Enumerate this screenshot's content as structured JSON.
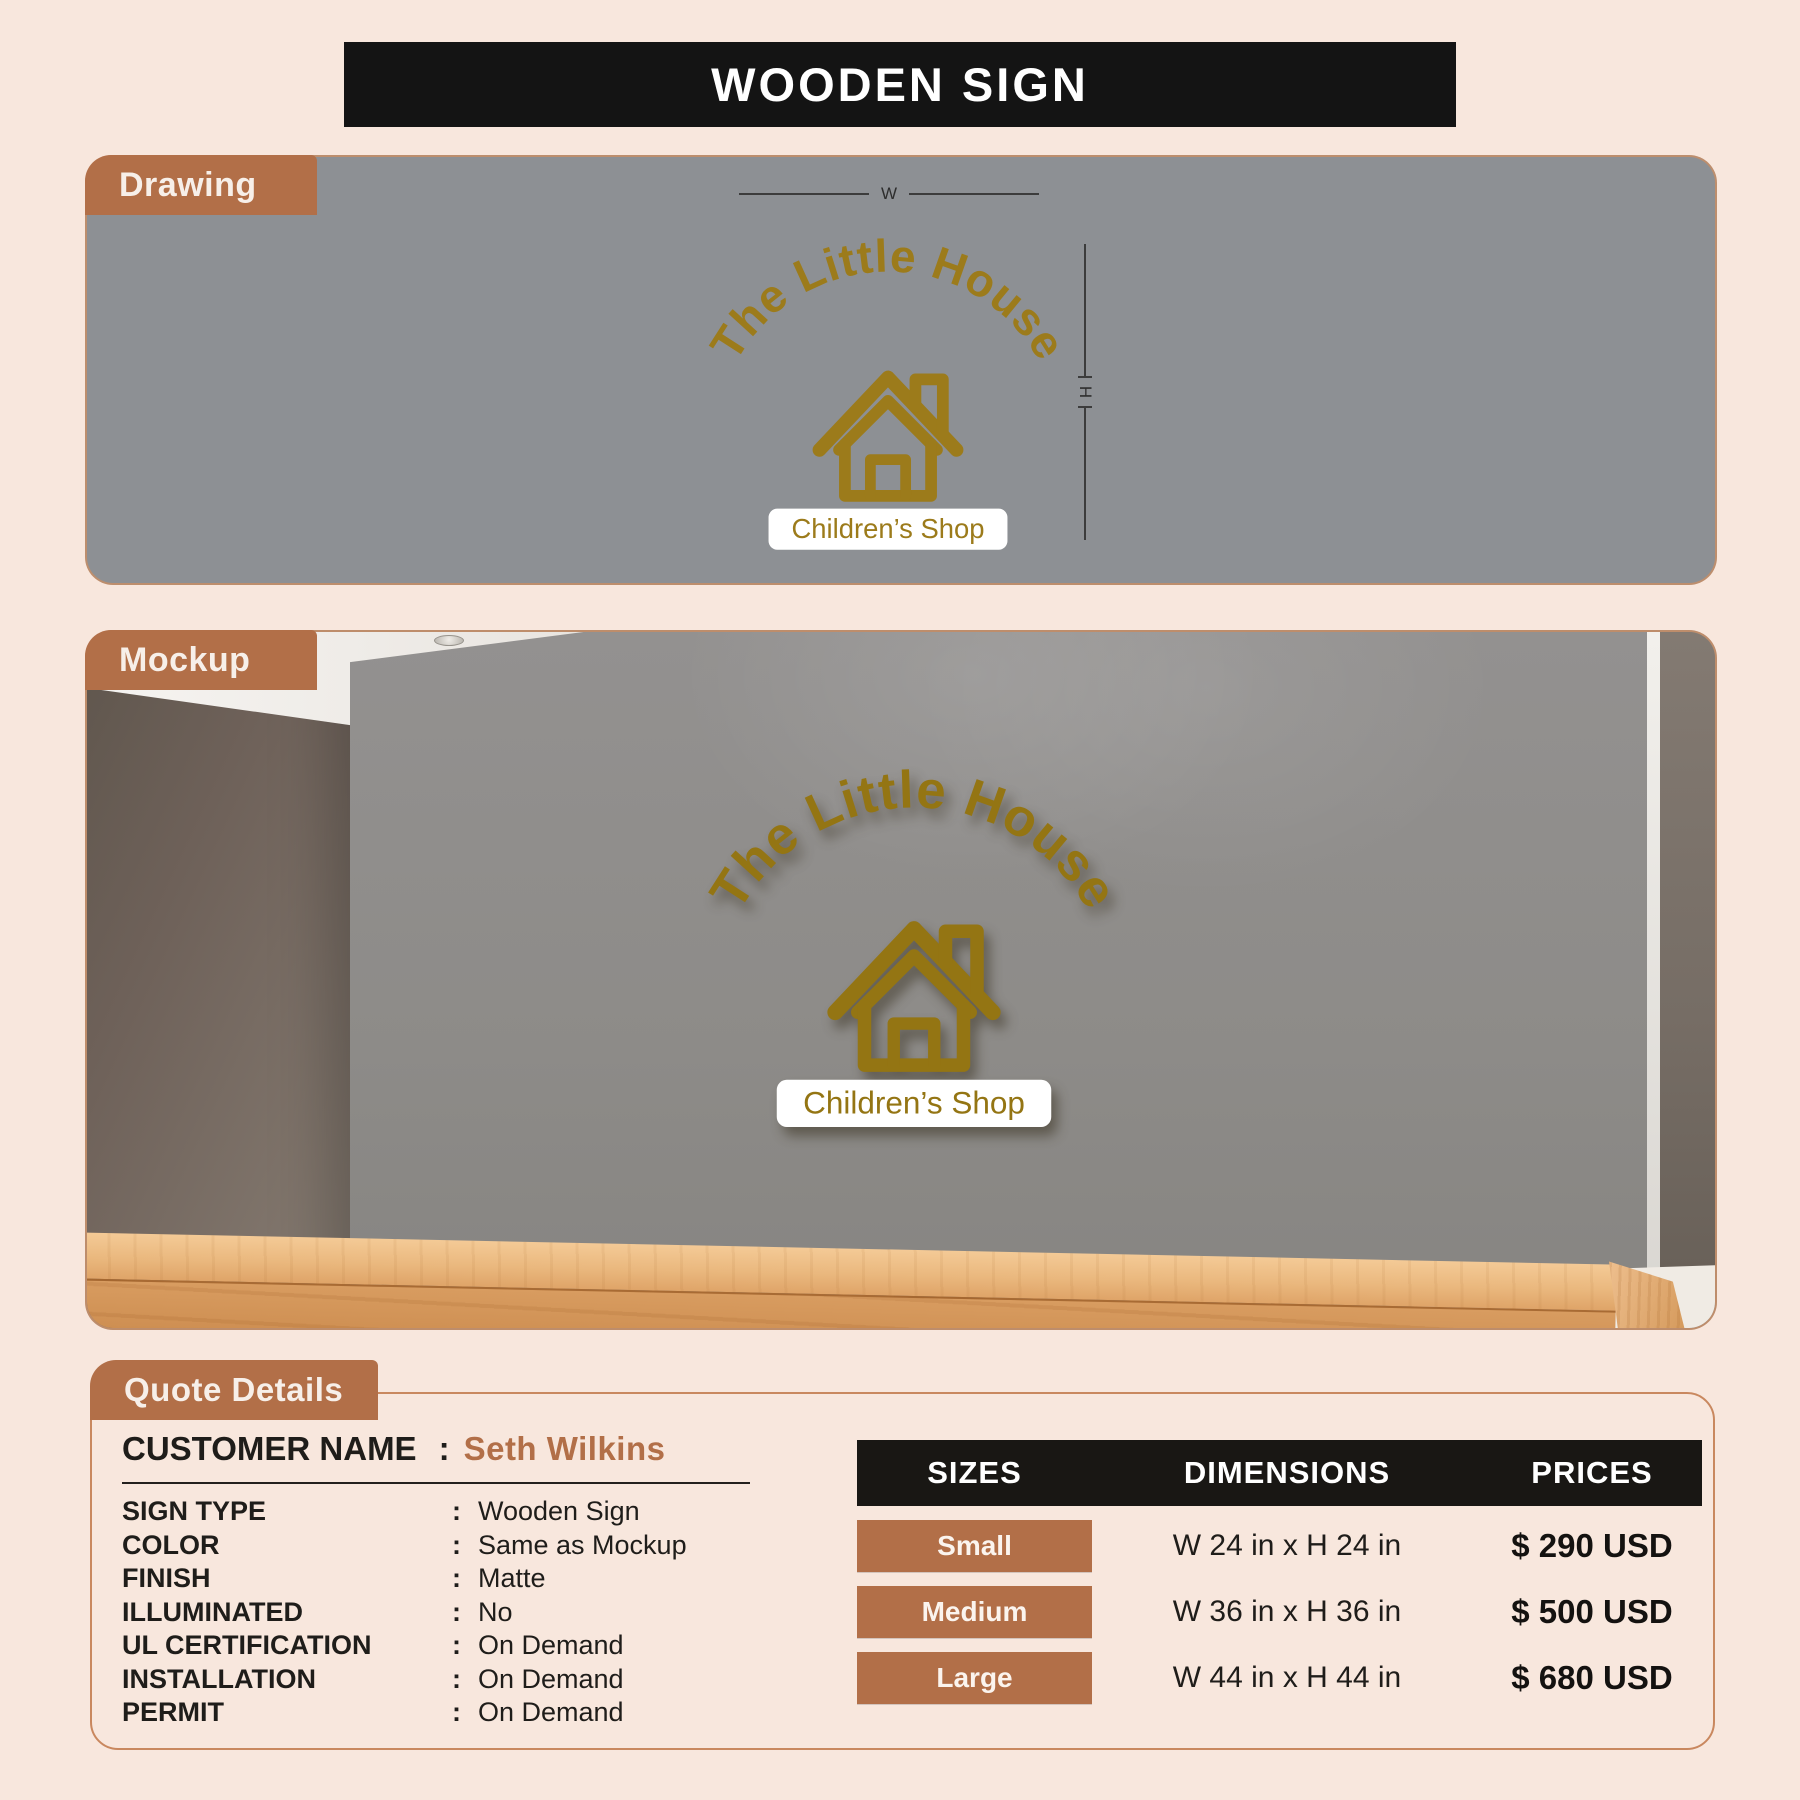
{
  "page": {
    "title": "WOODEN SIGN"
  },
  "sections": {
    "drawing_label": "Drawing",
    "mockup_label": "Mockup",
    "quote_label": "Quote Details"
  },
  "logo": {
    "name": "The Little House",
    "tagline": "Children’s Shop"
  },
  "dims": {
    "w": "W",
    "h": "H"
  },
  "quote": {
    "customer_label": "CUSTOMER NAME",
    "colon": ":",
    "customer_name": "Seth Wilkins",
    "fields": [
      {
        "label": "SIGN TYPE",
        "value": "Wooden Sign"
      },
      {
        "label": "COLOR",
        "value": "Same as Mockup"
      },
      {
        "label": "FINISH",
        "value": "Matte"
      },
      {
        "label": "ILLUMINATED",
        "value": "No"
      },
      {
        "label": "UL CERTIFICATION",
        "value": "On Demand"
      },
      {
        "label": "INSTALLATION",
        "value": "On Demand"
      },
      {
        "label": "PERMIT",
        "value": "On Demand"
      }
    ]
  },
  "pricing": {
    "headers": [
      "SIZES",
      "DIMENSIONS",
      "PRICES"
    ],
    "rows": [
      {
        "size": "Small",
        "dimensions": "W 24 in x H 24 in",
        "price": "$ 290 USD"
      },
      {
        "size": "Medium",
        "dimensions": "W 36 in x H 36 in",
        "price": "$ 500 USD"
      },
      {
        "size": "Large",
        "dimensions": "W 44 in x H 44 in",
        "price": "$ 680 USD"
      }
    ]
  },
  "colors": {
    "background": "#f8e7dd",
    "accent_brown": "#b26f48",
    "logo_gold": "#9c7b1b",
    "header_black": "#191714",
    "drawing_gray": "#8d9094"
  }
}
